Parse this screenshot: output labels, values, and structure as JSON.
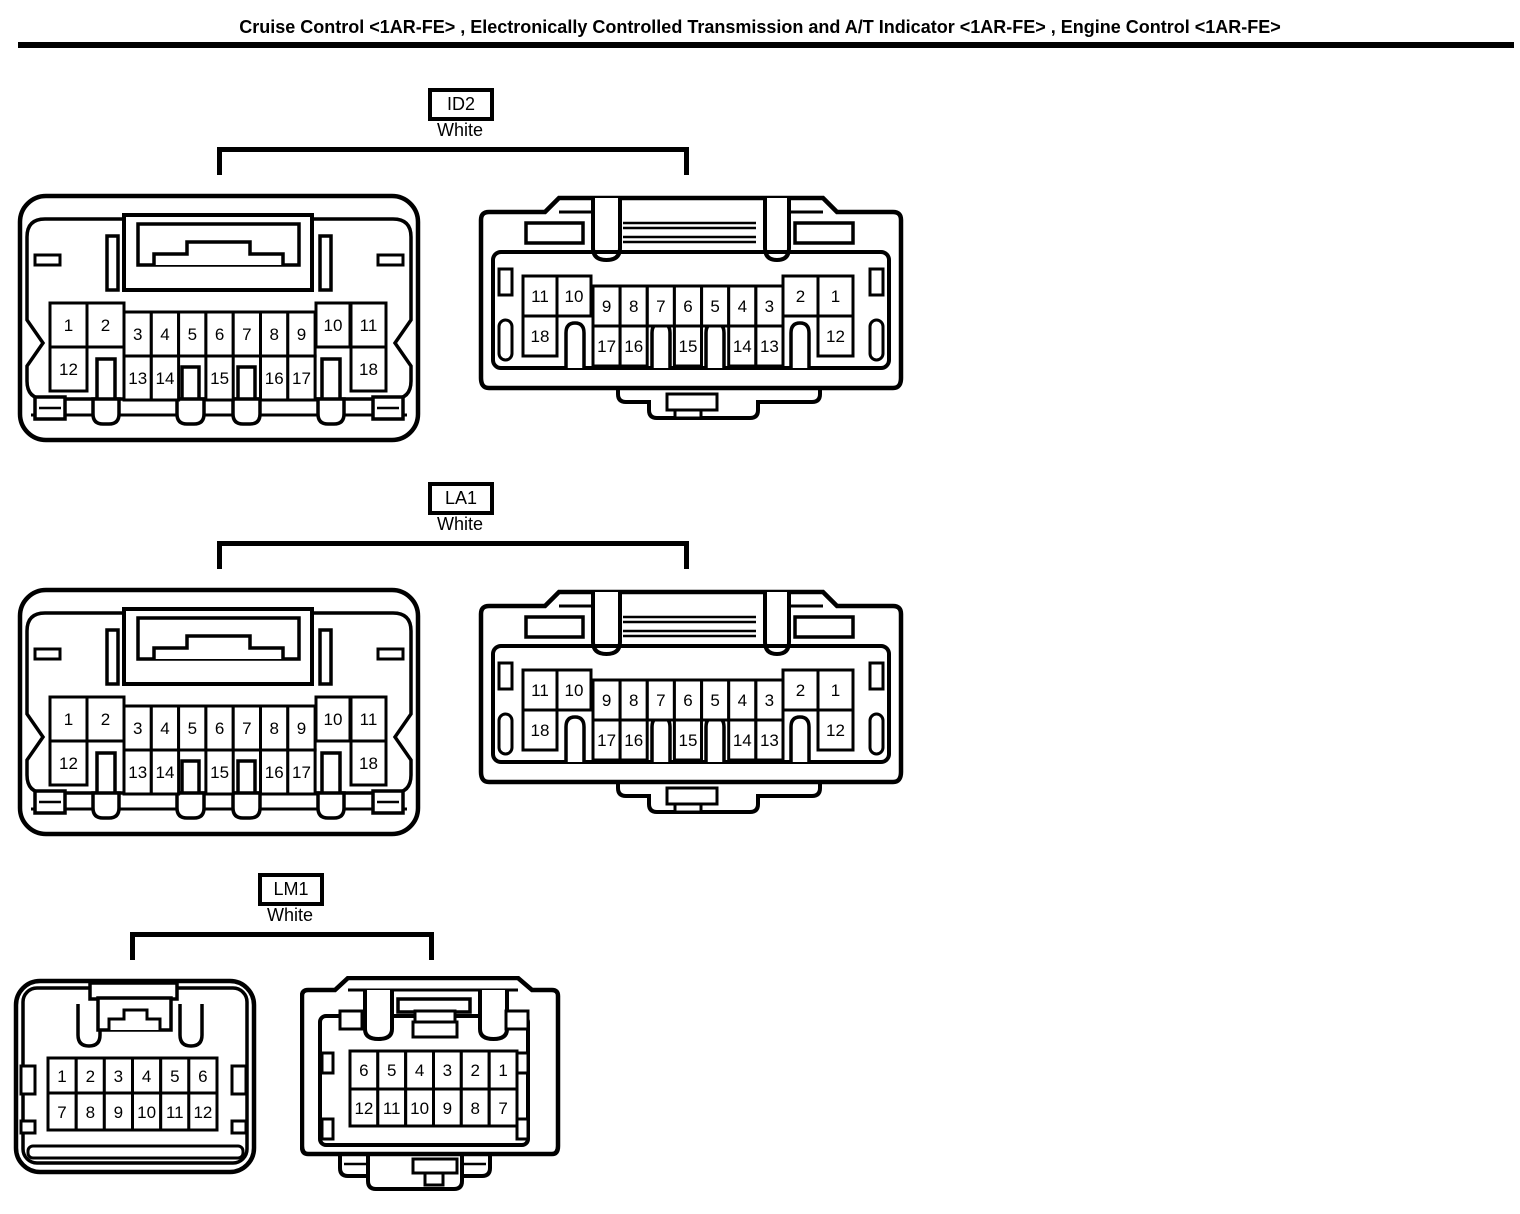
{
  "title": "Cruise Control <1AR-FE> , Electronically Controlled Transmission and A/T Indicator <1AR-FE> , Engine Control <1AR-FE>",
  "line_color": "#000000",
  "background_color": "#ffffff",
  "sections": [
    {
      "id": "ID2",
      "color": "White",
      "left": {
        "row1": [
          "1",
          "2",
          "3",
          "4",
          "5",
          "6",
          "7",
          "8",
          "9",
          "10",
          "11"
        ],
        "row2": [
          "12",
          "13",
          "14",
          "15",
          "16",
          "17",
          "18"
        ]
      },
      "right": {
        "row1": [
          "11",
          "10",
          "9",
          "8",
          "7",
          "6",
          "5",
          "4",
          "3",
          "2",
          "1"
        ],
        "row2": [
          "18",
          "17",
          "16",
          "15",
          "14",
          "13",
          "12"
        ]
      }
    },
    {
      "id": "LA1",
      "color": "White",
      "left": {
        "row1": [
          "1",
          "2",
          "3",
          "4",
          "5",
          "6",
          "7",
          "8",
          "9",
          "10",
          "11"
        ],
        "row2": [
          "12",
          "13",
          "14",
          "15",
          "16",
          "17",
          "18"
        ]
      },
      "right": {
        "row1": [
          "11",
          "10",
          "9",
          "8",
          "7",
          "6",
          "5",
          "4",
          "3",
          "2",
          "1"
        ],
        "row2": [
          "18",
          "17",
          "16",
          "15",
          "14",
          "13",
          "12"
        ]
      }
    },
    {
      "id": "LM1",
      "color": "White",
      "left": {
        "row1": [
          "1",
          "2",
          "3",
          "4",
          "5",
          "6"
        ],
        "row2": [
          "7",
          "8",
          "9",
          "10",
          "11",
          "12"
        ]
      },
      "right": {
        "row1": [
          "6",
          "5",
          "4",
          "3",
          "2",
          "1"
        ],
        "row2": [
          "12",
          "11",
          "10",
          "9",
          "8",
          "7"
        ]
      }
    }
  ]
}
